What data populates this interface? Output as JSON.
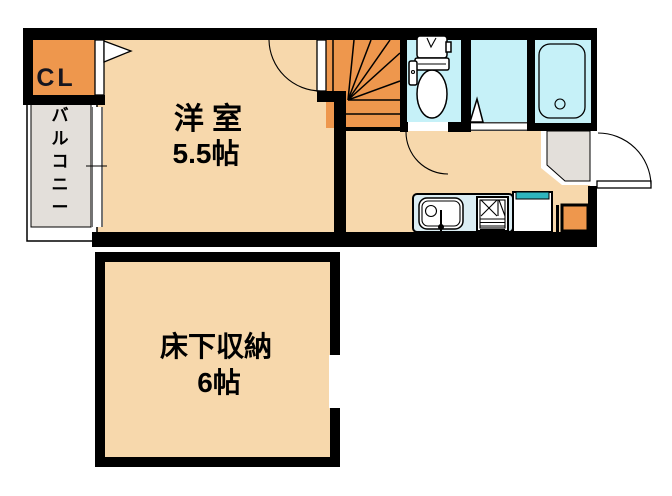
{
  "type": "floor-plan",
  "colors": {
    "wall": "#000000",
    "floor": "#F7D8AC",
    "accent": "#EE974D",
    "wet_area": "#C6F1F8",
    "counter": "#DBEDF3",
    "entry": "#E3DFDA",
    "appliance_top": "#2FB5BD",
    "background": "#FFFFFF"
  },
  "rooms": {
    "closet": {
      "label": "CL"
    },
    "balcony": {
      "label": "バルコニー"
    },
    "western_room": {
      "label": "洋 室",
      "size": "5.5帖"
    },
    "underfloor_storage": {
      "label": "床下収納",
      "size": "6帖"
    }
  }
}
